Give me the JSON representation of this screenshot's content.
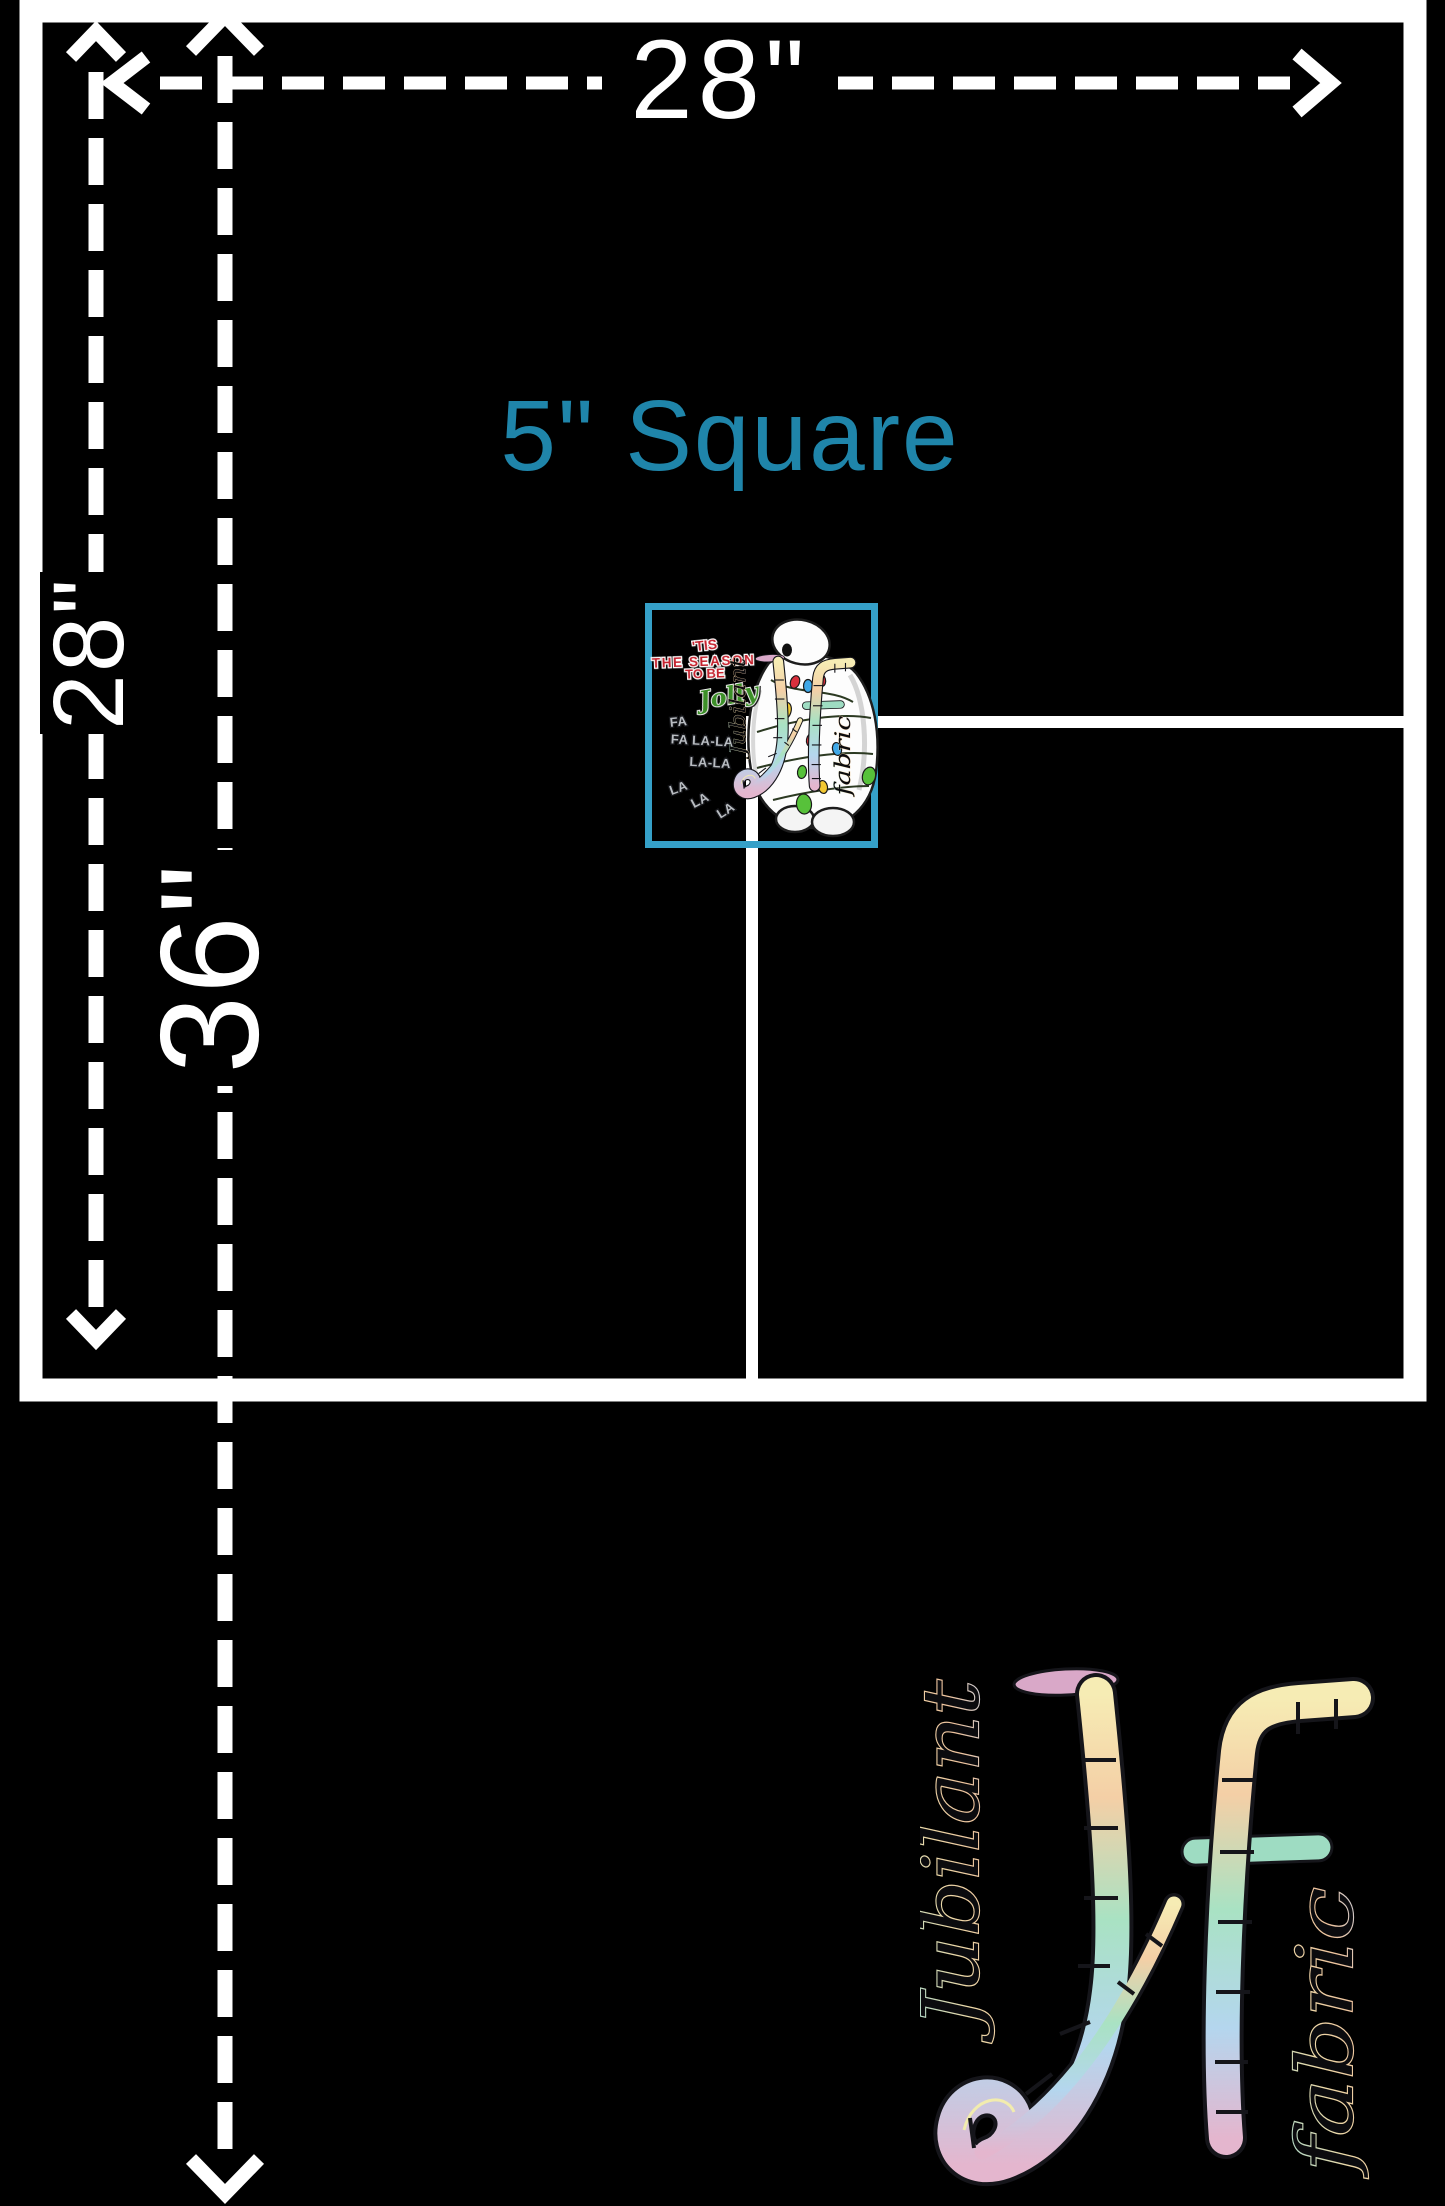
{
  "poster": {
    "colors": {
      "bg": "#000000",
      "line": "#ffffff",
      "accent": "#1f85aa",
      "swatch_border": "#35a0c8"
    },
    "measure": {
      "width_label": "28\"",
      "side_label": "28\"",
      "total_label": "36\"",
      "square_label": "5\" Square"
    },
    "swatch": {
      "print": {
        "tis": "'TIS",
        "season": "THE SEASON",
        "tobe": "TO BE",
        "jolly": "Jolly",
        "fa1": "FA",
        "fa2": "FA LA-LA",
        "la1": "LA-LA",
        "la2": "LA",
        "la3": "LA",
        "la4": "LA"
      }
    },
    "brand": {
      "monogram": "Jf",
      "word_jubilant": "Jubilant",
      "word_fabric": "fabric",
      "palette": {
        "cap_pink": "#d9a8c8",
        "yellow": "#f6ecb4",
        "peach": "#f4cfa6",
        "mint": "#a9e2c3",
        "blue": "#b4d6ee",
        "pink": "#e4b6ce",
        "teal_bar": "#9edcc2"
      }
    }
  }
}
